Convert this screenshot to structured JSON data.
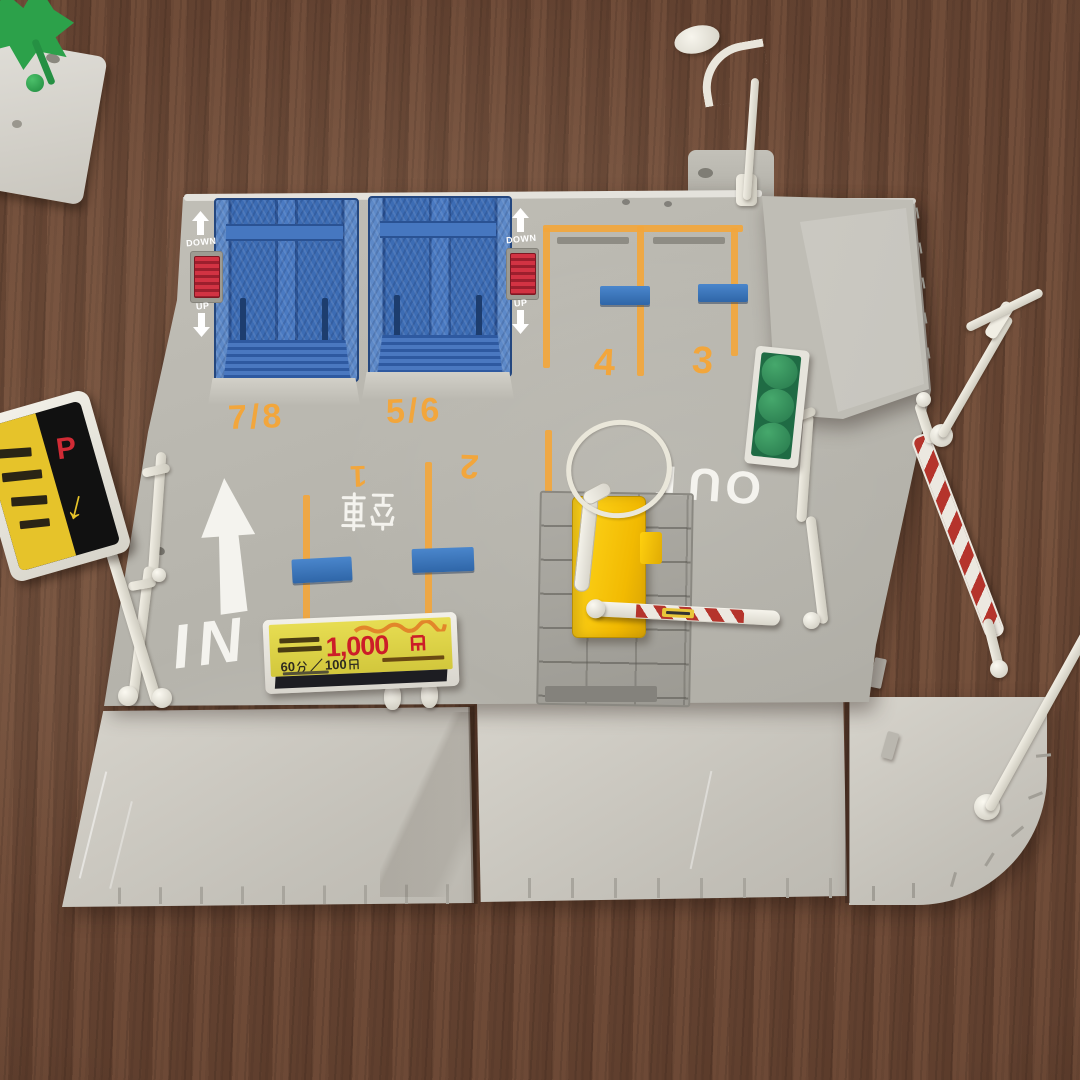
{
  "scene": {
    "description": "Tomica-style toy parking lot playset photographed on a brown wooden table",
    "objects": [
      "car lift ramps",
      "ticket machine with barrier gate",
      "parking entrance sign",
      "price signboard",
      "street lamps",
      "guardrails",
      "hedge planter",
      "road plates"
    ]
  },
  "colors": {
    "wood": "#6d4a38",
    "pavement": "#b4b2aa",
    "road_plate": "#cdcac2",
    "marking_orange": "#f2a63c",
    "lift_blue": "#3c6cb4",
    "machine_yellow": "#f7c800",
    "hazard_red": "#b5342c",
    "price_red": "#cc1d28",
    "sign_yellow": "#ded33f",
    "white_plastic": "#eceae2",
    "hedge_green": "#2f9058"
  },
  "markings": {
    "in": "IN",
    "out": "OUT",
    "vacant": "空車",
    "spaces": [
      "1",
      "2",
      "3",
      "4"
    ]
  },
  "lifts": {
    "left_label": "7/8",
    "right_label": "5/6",
    "up": "UP",
    "down": "DOWN"
  },
  "entrance_sign": {
    "letter": "P",
    "arrow": "↓"
  },
  "price_sign": {
    "line1": "最大料金 駐車後12時間",
    "amount": "1,000",
    "currency": "円",
    "amount_full": "1,000円",
    "rate": "60分／100円",
    "rate_minutes": "60",
    "rate_separator": "／",
    "rate_price": "100"
  }
}
